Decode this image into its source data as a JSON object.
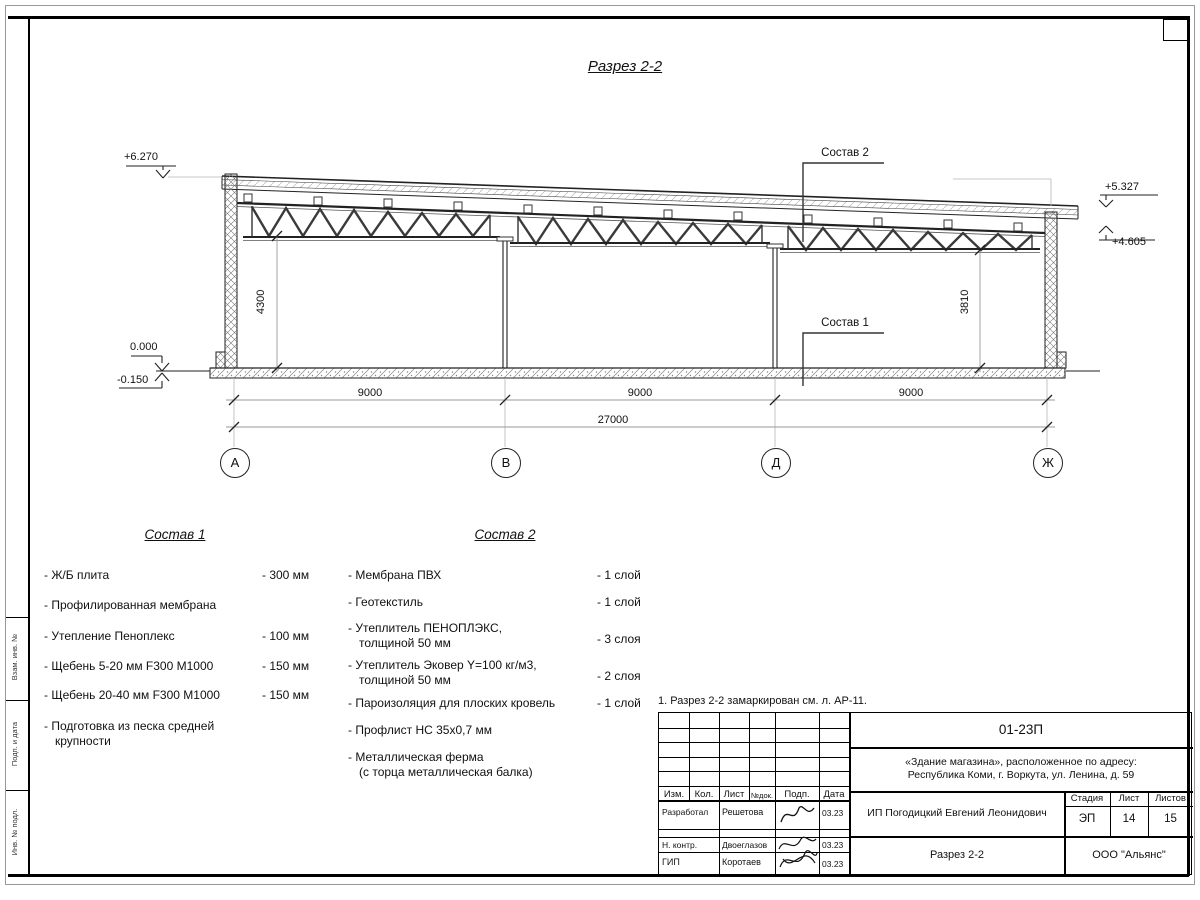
{
  "sheet": {
    "title": "Разрез 2-2",
    "note": "1. Разрез 2-2 замаркирован см. л. АР-11."
  },
  "drawing": {
    "elevations": {
      "top_left": "+6.270",
      "zero": "0.000",
      "below_zero": "-0.150",
      "right_upper": "+5.327",
      "right_lower": "+4.605"
    },
    "dims": {
      "height_left": "4300",
      "height_right": "3810",
      "span_1": "9000",
      "span_2": "9000",
      "span_3": "9000",
      "total": "27000"
    },
    "axes": [
      "А",
      "В",
      "Д",
      "Ж"
    ],
    "callout_top": "Состав 2",
    "callout_bottom": "Состав 1"
  },
  "composition1": {
    "heading": "Состав 1",
    "items": [
      {
        "name": "- Ж/Б плита",
        "value": "- 300 мм"
      },
      {
        "name": "- Профилированная мембрана",
        "value": ""
      },
      {
        "name": "- Утепление Пеноплекс",
        "value": "- 100 мм"
      },
      {
        "name": "-  Щебень 5-20 мм F300 М1000",
        "value": "- 150 мм"
      },
      {
        "name": "-  Щебень 20-40 мм F300 М1000",
        "value": "- 150 мм"
      },
      {
        "name": "- Подготовка из песка средней крупности",
        "value": ""
      }
    ]
  },
  "composition2": {
    "heading": "Состав 2",
    "items": [
      {
        "name": "- Мембрана ПВХ",
        "value": "- 1 слой"
      },
      {
        "name": "- Геотекстиль",
        "value": "- 1 слой"
      },
      {
        "name": "- Утеплитель ПЕНОПЛЭКС,\nтолщиной 50 мм",
        "value": "- 3 слоя"
      },
      {
        "name": "- Утеплитель Эковер Y=100 кг/м3,\nтолщиной 50 мм",
        "value": "- 2 слоя"
      },
      {
        "name": "- Пароизоляция для плоских кровель",
        "value": "- 1 слой"
      },
      {
        "name": "- Профлист НС 35х0,7 мм",
        "value": ""
      },
      {
        "name": "- Металлическая ферма\n(с торца металлическая балка)",
        "value": ""
      }
    ]
  },
  "titleblock": {
    "doc_number": "01-23П",
    "project_address": "«Здание магазина», расположенное по адресу:\nРеспублика Коми, г. Воркута, ул. Ленина, д. 59",
    "client": "ИП Погодицкий Евгений Леонидович",
    "drawing_name": "Разрез 2-2",
    "company": "ООО \"Альянс\"",
    "stage_label": "Стадия",
    "sheet_label": "Лист",
    "sheets_label": "Листов",
    "stage": "ЭП",
    "sheet_number": "14",
    "sheets_total": "15",
    "columns": {
      "izm": "Изм.",
      "kol": "Кол.",
      "list": "Лист",
      "ndok": "№док.",
      "podp": "Подп.",
      "data": "Дата"
    },
    "signers": [
      {
        "role": "Разработал",
        "name": "Решетова",
        "date": "03.23"
      },
      {
        "role": "Н. контр.",
        "name": "Двоеглазов",
        "date": "03.23"
      },
      {
        "role": "ГИП",
        "name": "Коротаев",
        "date": "03.23"
      }
    ]
  },
  "side_stamp": {
    "labels": [
      "Взам. инв. №",
      "Подп. и дата",
      "Инв. № подл."
    ]
  }
}
